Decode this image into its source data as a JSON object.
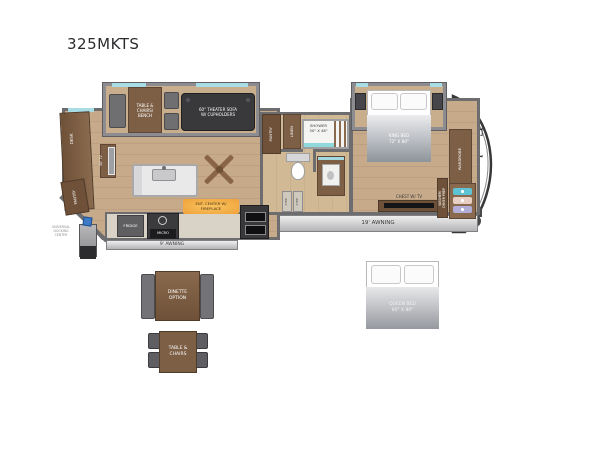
{
  "title": "325MKTS",
  "living_slide": {
    "table_label": "TABLE &\nCHAIRS/\nBENCH",
    "sofa_label": "60\" THEATER SOFA\nW/ CUPHOLDERS"
  },
  "rear_wall": {
    "desk_label": "DESK",
    "tv_label": "50\" TV",
    "pantry_label": "PANTRY"
  },
  "kitchen": {
    "fridge_label": "FRIDGE",
    "range_label": "MICRO",
    "fireplace_label": "ENT. CENTER W/\nFIREPLACE"
  },
  "bath": {
    "pantry_label": "PANTRY",
    "linen_label": "LINEN",
    "shower_label": "SHOWER\n30\" X 48\"",
    "step_label_1": "STEP",
    "step_label_2": "STEP"
  },
  "bedroom": {
    "bed_label": "KING BED\n72\" X 80\"",
    "chest_label": "CHEST W/ TV",
    "wardrobe_label": "WARDROBE",
    "wd_label": "WASHER/\nDRYER PREP"
  },
  "exterior": {
    "awning_19": "19' AWNING",
    "awning_9": "9' AWNING",
    "dock_label": "UNIVERSAL\nDOCKING\nCENTER",
    "brand_logo": "Eagle"
  },
  "options": {
    "dinette_label": "DINETTE\nOPTION",
    "table_chairs_label": "TABLE &\nCHAIRS",
    "queen_label": "QUEEN BED\n60\" X 80\""
  }
}
